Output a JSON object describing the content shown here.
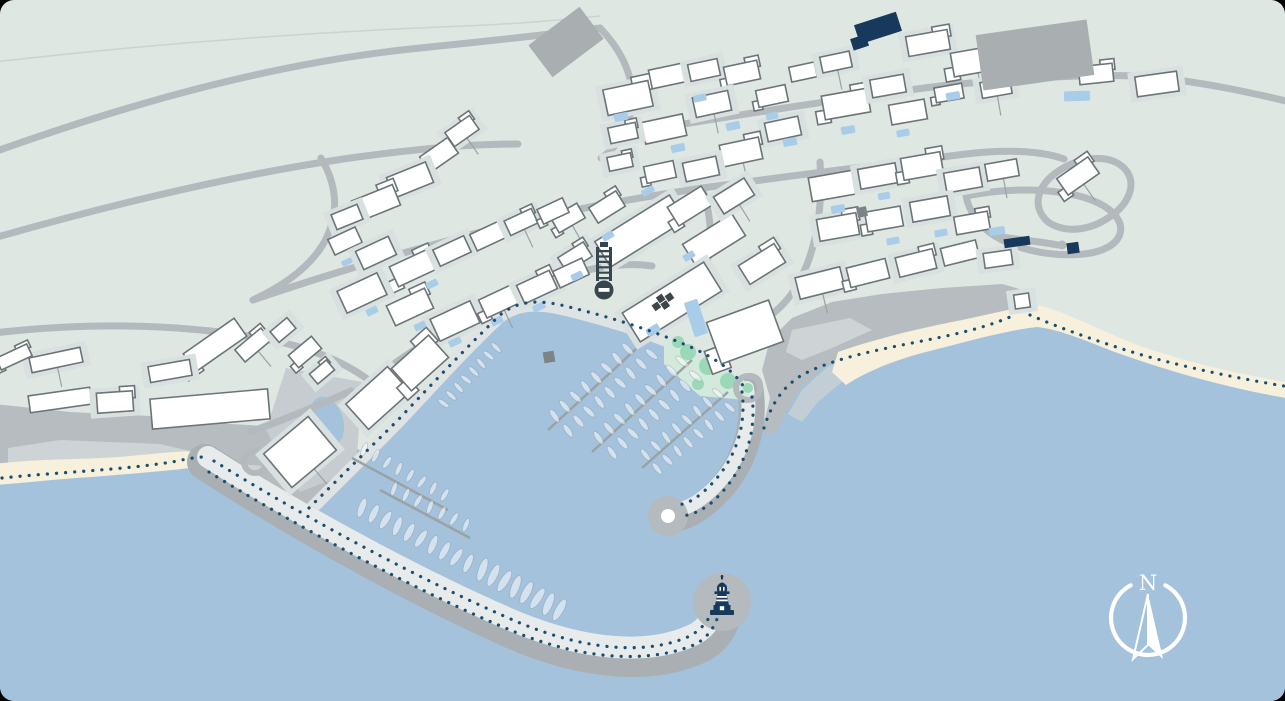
{
  "compass": {
    "label": "N",
    "cx": 1148,
    "cy": 618,
    "r": 37
  },
  "colors": {
    "land": "#dee7e1",
    "sea": "#a4c2db",
    "shallow": "#c6ced4",
    "sand": "#f6f0dc",
    "cliff": "#b6bcbf",
    "cliff_light": "#ced4d6",
    "plaza": "#c6cccf",
    "road": "#b3b9bc",
    "quay": "#dfe3e4",
    "bw_dark": "#a9afb2",
    "bw_light": "#e8ebec",
    "bw_head": "#b4babd",
    "park": "#d2e9db",
    "tree": "#9bd8b8",
    "pier": "#9aa2a5",
    "dot": "#1b4f6f",
    "building": "#ffffff",
    "building_stroke": "#6d7478",
    "pad": "#d9e0e0",
    "gray_building": "#a9aeb1",
    "navy": "#17395c",
    "pool": "#a9cde9",
    "utility": "#7b8487",
    "contour": "#cbd4ce",
    "boat_fill": "rgba(255,255,255,0.52)",
    "boat_stroke": "rgba(125,140,152,0.4)",
    "white": "#ffffff"
  },
  "map": {
    "sea_path": "M-6,482 L120,472 L204,458 L307,513 L396,424 C430,388 462,352 498,318 C520,300 546,304 572,311 C612,321 654,334 694,352 C722,365 740,379 752,404 L764,420 L778,396 L794,378 L832,357 L885,343 L940,331 L990,319 L1016,308 L1034,306 L1064,320 L1120,342 L1180,360 L1240,374 L1286,383 L1286,702 L-6,702 Z",
    "contours": [
      "M-6,62 C150,44 300,33 440,27 C520,24 560,20 600,16"
    ],
    "cliffs": [
      "M-6,404 L70,412 L150,416 L230,424 L300,428 L344,440 L362,452 L307,513 L205,462 L150,468 L80,476 L-6,484 Z",
      "M762,432 L770,398 L762,370 L770,340 L792,318 L832,302 L882,294 L942,288 L1002,284 L1030,292 L1036,300 L1010,312 L960,322 L905,334 L858,348 L825,366 L800,388 L786,412 L776,434 Z"
    ],
    "cliff_lights": [
      "M60,440 L160,444 L212,456 L150,466 L70,470 L8,466 L8,448 Z",
      "M216,462 L262,466 L250,492 L210,486 Z",
      "M792,330 L850,318 L872,330 L832,348 L802,360 L786,352 Z"
    ],
    "shallows": [
      "M788,414 L802,390 L826,368 L860,350 L872,360 L842,382 L818,402 L802,422 Z"
    ],
    "plazas": [
      "M286,368 L362,382 L356,470 L300,492 L266,430 Z"
    ],
    "beaches": [
      "M-6,464 C40,458 90,460 130,456 C162,453 186,450 202,452 L206,466 C162,472 102,476 52,480 C32,482 10,484 -6,485 Z",
      "M838,352 C872,340 912,330 952,322 C992,314 1022,305 1042,306 C1064,312 1094,327 1132,343 C1182,361 1232,373 1286,382 L1286,398 C1222,387 1162,369 1112,351 C1082,339 1057,329 1037,327 C1002,331 962,343 922,353 C892,361 864,373 846,385 L832,372 Z"
    ],
    "quay": {
      "band": "M307,513 L396,424 C430,388 462,352 498,318 C520,300 546,304 572,311 C612,321 654,334 694,352 C722,365 740,379 749,395",
      "dots": "M309,508 L398,420 C432,384 464,350 500,315 C522,297 547,301 573,308 C613,318 655,331 695,349 C722,362 738,375 746,391"
    },
    "breakwaters": [
      {
        "dark": "M205,462 C300,524 420,590 515,632 C585,662 652,668 700,645 C716,637 723,622 725,606",
        "light": "M208,457 C302,517 422,582 516,622 C584,650 648,656 693,635 C707,628 714,616 716,604",
        "dw": 36,
        "lw": 22,
        "head": [
          722,
          602,
          29
        ],
        "head_inner": null,
        "dot_rows": [
          "M214,461 C306,518 426,583 520,623 C588,651 648,655 690,636 C702,629 709,620 713,609",
          "M209,472 C300,528 420,593 515,632 C584,660 650,664 696,644 C708,637 715,627 719,613"
        ]
      },
      {
        "dark": "M750,386 C757,428 743,472 707,502 C693,514 679,520 669,519",
        "light": "M747,388 C753,426 740,466 706,495 C695,504 685,509 677,509",
        "dw": 26,
        "lw": 14,
        "head": [
          668,
          516,
          20
        ],
        "head_inner": [
          668,
          516,
          7
        ],
        "dot_rows": [
          "M742,392 C747,428 734,466 702,493 C694,500 686,504 678,505",
          "M752,397 C757,433 744,475 710,504 C701,511 691,515 682,516"
        ]
      }
    ],
    "park": {
      "poly": "M664,336 L754,386 L746,400 L700,396 L664,364 Z",
      "trees": [
        [
          688,
          352,
          8
        ],
        [
          708,
          366,
          9
        ],
        [
          728,
          381,
          8
        ],
        [
          698,
          384,
          6
        ],
        [
          678,
          342,
          6
        ]
      ]
    },
    "pond": {
      "cx": 327,
      "cy": 421,
      "rx": 16,
      "ry": 25,
      "rot": -18
    },
    "roundabouts": [
      {
        "cx": 255,
        "cy": 462,
        "r": 11,
        "w": 6,
        "green": false
      },
      {
        "cx": 748,
        "cy": 388,
        "r": 12,
        "w": 6,
        "green": true
      }
    ],
    "road_dots": [
      [
        1062,
        245,
        4.5
      ]
    ],
    "roads": [
      "M-6,152 C140,100 280,62 420,48 C490,41 544,35 600,28",
      "M-6,238 C120,202 240,174 350,158 C424,148 472,144 518,144",
      "M-6,333 C90,322 180,324 260,338 C306,346 342,360 370,381",
      "M600,28 C626,55 639,88 629,119 C623,139 612,151 601,158",
      "M610,136 C720,118 830,100 940,86 C1030,77 1112,72 1162,78 C1212,84 1252,93 1286,101",
      "M321,158 C340,190 338,220 322,246 C308,268 283,286 253,300",
      "M253,300 C340,270 432,244 520,222 C602,203 652,196 702,188",
      "M702,188 C790,176 882,164 966,154 C1010,149 1042,151 1064,159",
      "M966,196 C1016,186 1073,188 1104,206 C1133,224 1123,250 1084,254 C1045,258 1011,246 995,236 C980,227 969,212 966,196 Z",
      "M820,162 C823,205 817,245 802,276 C794,293 783,306 771,315",
      "M702,188 C713,220 713,250 703,274 C696,291 684,303 670,312",
      "M370,381 C422,343 474,309 532,287 C588,266 624,262 652,266",
      "M250,432 C283,420 317,406 351,391",
      "M1048,222 C1030,206 1038,184 1060,170 C1082,156 1110,154 1124,168 C1138,182 1130,204 1108,218 C1090,230 1066,234 1048,222 Z",
      "M995,236 C1020,240 1044,242 1058,245"
    ],
    "piers": [
      [
        648,
        338,
        548,
        430
      ],
      [
        692,
        360,
        592,
        452
      ],
      [
        728,
        392,
        642,
        468
      ],
      [
        352,
        458,
        448,
        510
      ],
      [
        380,
        490,
        470,
        538
      ]
    ],
    "boat_rows": [
      {
        "l": [
          650,
          342,
          556,
          428
        ],
        "n": 9,
        "len": 15,
        "wid": 5.5,
        "sides": 2,
        "gap": 10,
        "dir": -1
      },
      {
        "l": [
          694,
          364,
          600,
          450
        ],
        "n": 9,
        "len": 15,
        "wid": 5.5,
        "sides": 2,
        "gap": 10,
        "dir": -1
      },
      {
        "l": [
          729,
          396,
          646,
          466
        ],
        "n": 8,
        "len": 14,
        "wid": 5,
        "sides": 2,
        "gap": 9,
        "dir": -1
      },
      {
        "l": [
          350,
          516,
          468,
          578
        ],
        "n": 10,
        "len": 20,
        "wid": 7,
        "sides": 1,
        "gap": 13,
        "dir": -1
      },
      {
        "l": [
          470,
          580,
          558,
          626
        ],
        "n": 8,
        "len": 24,
        "wid": 8,
        "sides": 1,
        "gap": 15,
        "dir": -1
      },
      {
        "l": [
          434,
          402,
          494,
          338
        ],
        "n": 8,
        "len": 13,
        "wid": 4.5,
        "sides": 1,
        "gap": 8,
        "dir": 1
      },
      {
        "l": [
          354,
          454,
          446,
          506
        ],
        "n": 8,
        "len": 14,
        "wid": 5,
        "sides": 1,
        "gap": 9,
        "dir": -1
      },
      {
        "l": [
          384,
          494,
          468,
          536
        ],
        "n": 7,
        "len": 14,
        "wid": 5,
        "sides": 1,
        "gap": 9,
        "dir": -1
      }
    ],
    "buildings": [
      [
        462,
        131,
        30,
        17,
        -35
      ],
      [
        439,
        155,
        34,
        19,
        -35
      ],
      [
        410,
        180,
        42,
        22,
        -22
      ],
      [
        376,
        203,
        44,
        22,
        -22
      ],
      [
        347,
        217,
        28,
        16,
        -22
      ],
      [
        568,
        218,
        30,
        17,
        -30
      ],
      [
        628,
        98,
        46,
        26,
        -12
      ],
      [
        667,
        76,
        34,
        19,
        -12
      ],
      [
        704,
        70,
        30,
        17,
        -12
      ],
      [
        742,
        73,
        34,
        19,
        -12
      ],
      [
        712,
        104,
        36,
        20,
        -12
      ],
      [
        664,
        129,
        42,
        22,
        -12
      ],
      [
        623,
        133,
        28,
        16,
        -12
      ],
      [
        772,
        96,
        30,
        17,
        -12
      ],
      [
        783,
        129,
        34,
        19,
        -12
      ],
      [
        741,
        152,
        40,
        22,
        -12
      ],
      [
        701,
        169,
        34,
        19,
        -12
      ],
      [
        660,
        172,
        30,
        17,
        -12
      ],
      [
        620,
        162,
        24,
        14,
        -12
      ],
      [
        803,
        72,
        26,
        15,
        -12
      ],
      [
        836,
        62,
        30,
        16,
        -12
      ],
      [
        846,
        104,
        46,
        24,
        -10
      ],
      [
        888,
        86,
        34,
        18,
        -10
      ],
      [
        908,
        112,
        36,
        20,
        -10
      ],
      [
        928,
        43,
        42,
        20,
        -10
      ],
      [
        976,
        61,
        48,
        24,
        -10
      ],
      [
        1038,
        63,
        44,
        22,
        -8
      ],
      [
        1096,
        74,
        34,
        18,
        -6
      ],
      [
        1157,
        84,
        42,
        20,
        -8
      ],
      [
        949,
        93,
        28,
        15,
        -10
      ],
      [
        996,
        88,
        30,
        16,
        -10
      ],
      [
        832,
        186,
        44,
        24,
        -10
      ],
      [
        878,
        176,
        38,
        20,
        -10
      ],
      [
        922,
        166,
        40,
        22,
        -10
      ],
      [
        963,
        180,
        36,
        20,
        -10
      ],
      [
        1002,
        170,
        32,
        17,
        -10
      ],
      [
        838,
        227,
        40,
        22,
        -10
      ],
      [
        884,
        219,
        36,
        20,
        -10
      ],
      [
        930,
        209,
        38,
        20,
        -10
      ],
      [
        972,
        223,
        34,
        18,
        -10
      ],
      [
        820,
        283,
        46,
        22,
        -14
      ],
      [
        868,
        273,
        40,
        20,
        -14
      ],
      [
        916,
        263,
        38,
        20,
        -14
      ],
      [
        960,
        253,
        36,
        18,
        -14
      ],
      [
        998,
        259,
        28,
        15,
        -8
      ],
      [
        1078,
        176,
        38,
        20,
        -35
      ],
      [
        640,
        231,
        88,
        30,
        -32
      ],
      [
        714,
        240,
        58,
        26,
        -32
      ],
      [
        762,
        264,
        42,
        22,
        -32
      ],
      [
        690,
        206,
        40,
        22,
        -32
      ],
      [
        734,
        196,
        36,
        20,
        -32
      ],
      [
        607,
        207,
        32,
        18,
        -32
      ],
      [
        672,
        302,
        96,
        34,
        -32
      ],
      [
        745,
        332,
        66,
        44,
        -20
      ],
      [
        575,
        257,
        30,
        17,
        -32
      ],
      [
        345,
        241,
        30,
        17,
        -25
      ],
      [
        376,
        253,
        36,
        20,
        -25
      ],
      [
        413,
        268,
        42,
        22,
        -25
      ],
      [
        452,
        251,
        34,
        18,
        -25
      ],
      [
        488,
        236,
        32,
        18,
        -25
      ],
      [
        521,
        222,
        30,
        16,
        -25
      ],
      [
        553,
        211,
        28,
        16,
        -25
      ],
      [
        362,
        293,
        44,
        24,
        -25
      ],
      [
        410,
        307,
        42,
        22,
        -25
      ],
      [
        455,
        321,
        44,
        24,
        -25
      ],
      [
        500,
        301,
        38,
        20,
        -25
      ],
      [
        537,
        287,
        36,
        20,
        -25
      ],
      [
        571,
        273,
        32,
        18,
        -25
      ],
      [
        378,
        398,
        56,
        34,
        -42
      ],
      [
        420,
        363,
        50,
        30,
        -42
      ],
      [
        56,
        360,
        52,
        15,
        -12
      ],
      [
        60,
        400,
        62,
        17,
        -8
      ],
      [
        115,
        402,
        36,
        20,
        -4
      ],
      [
        215,
        345,
        62,
        22,
        -35
      ],
      [
        170,
        371,
        42,
        16,
        -10
      ],
      [
        253,
        345,
        34,
        16,
        -40
      ],
      [
        283,
        330,
        22,
        14,
        -40
      ],
      [
        305,
        352,
        30,
        16,
        -40
      ],
      [
        322,
        372,
        22,
        13,
        -40
      ],
      [
        210,
        409,
        118,
        30,
        -5
      ],
      [
        300,
        452,
        58,
        44,
        -40
      ],
      [
        14,
        357,
        34,
        13,
        -25
      ],
      [
        1022,
        301,
        15,
        14,
        -8
      ]
    ],
    "gray_buildings": [
      [
        566,
        42,
        64,
        40,
        -37
      ],
      [
        1035,
        55,
        112,
        56,
        -8
      ]
    ],
    "navy_buildings": [
      [
        878,
        28,
        44,
        20,
        -18
      ],
      [
        1017,
        242,
        26,
        9,
        -8
      ],
      [
        1073,
        248,
        12,
        11,
        -8
      ]
    ],
    "utilities": [
      [
        549,
        357,
        11,
        -10
      ],
      [
        862,
        212,
        10,
        -12
      ]
    ],
    "pools": [
      [
        621,
        117,
        14,
        8,
        -12
      ],
      [
        678,
        148,
        14,
        8,
        -12
      ],
      [
        733,
        126,
        14,
        8,
        -12
      ],
      [
        790,
        142,
        14,
        8,
        -10
      ],
      [
        848,
        130,
        14,
        8,
        -10
      ],
      [
        903,
        133,
        13,
        7,
        -10
      ],
      [
        953,
        96,
        14,
        8,
        -10
      ],
      [
        1077,
        96,
        26,
        10,
        -2
      ],
      [
        838,
        209,
        14,
        8,
        -10
      ],
      [
        893,
        241,
        13,
        7,
        -10
      ],
      [
        941,
        233,
        13,
        7,
        -10
      ],
      [
        997,
        231,
        16,
        8,
        -8
      ],
      [
        648,
        191,
        13,
        7,
        -30
      ],
      [
        608,
        236,
        12,
        7,
        -30
      ],
      [
        577,
        276,
        12,
        7,
        -25
      ],
      [
        539,
        307,
        13,
        7,
        -25
      ],
      [
        497,
        321,
        12,
        7,
        -25
      ],
      [
        455,
        342,
        13,
        7,
        -25
      ],
      [
        420,
        326,
        12,
        7,
        -25
      ],
      [
        372,
        311,
        12,
        7,
        -25
      ],
      [
        347,
        262,
        11,
        6,
        -25
      ],
      [
        432,
        284,
        12,
        7,
        -25
      ],
      [
        696,
        318,
        14,
        36,
        -18
      ],
      [
        700,
        98,
        13,
        7,
        -12
      ],
      [
        772,
        116,
        12,
        7,
        -12
      ],
      [
        884,
        196,
        12,
        7,
        -10
      ],
      [
        689,
        256,
        12,
        7,
        -32
      ],
      [
        653,
        330,
        14,
        8,
        -32
      ]
    ],
    "dotted": [
      "M2,478 C60,472 122,470 172,462 C186,459 197,457 204,457",
      "M764,428 C772,402 784,386 802,375 C832,359 872,351 912,343 C952,335 982,329 1010,317",
      "M1030,315 C1062,329 1102,343 1142,355 C1192,369 1242,379 1284,386"
    ],
    "landmarks": {
      "spiral": {
        "x": 604,
        "y": 268
      },
      "cross": {
        "x": 662,
        "y": 303,
        "rot": -35
      },
      "lighthouse": {
        "x": 722,
        "y": 601
      }
    }
  }
}
